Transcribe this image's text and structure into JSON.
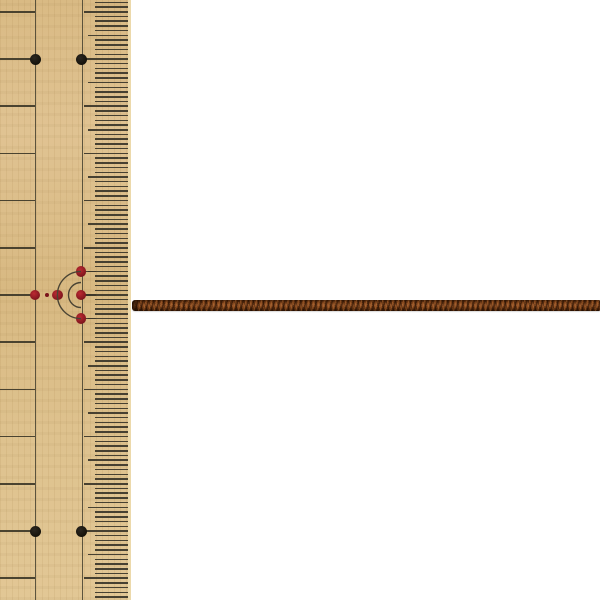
{
  "scene": {
    "width": 600,
    "height": 600,
    "background_color": "#ffffff",
    "description": "Product photo: thin brown braided cord laid horizontally across a white background, wooden ruler along the left edge for scale"
  },
  "ruler": {
    "kind": "wooden-measuring-ruler",
    "x": 0,
    "y": 0,
    "width": 131,
    "height": 600,
    "base_color": "#dcbf8c",
    "edge_strip": {
      "x": 128,
      "width": 3,
      "color": "#ecd9ab"
    },
    "line_color": "#3e3a2b",
    "tick_color": "#3a3529",
    "vertical_lines_x": [
      35,
      82
    ],
    "grid": {
      "phase_y": 11.8,
      "cm_spacing": 47.2,
      "mm_spacing": 4.72
    },
    "left_lines": {
      "x_start": 0,
      "x_end": 35,
      "thickness": 1.6
    },
    "ticks": {
      "mm_x_start": 95,
      "half_cm_x_start": 88,
      "cm_x_start": 83.5,
      "x_end": 128,
      "thickness": 1.5
    },
    "black_dots": {
      "color_outer": "#2b2720",
      "color_inner": "#141109",
      "radius": 5.5,
      "rows_y": [
        59,
        531
      ],
      "cols_x": [
        35.5,
        81
      ]
    },
    "red_mark": {
      "dot_color_outer": "#bc2a32",
      "dot_color_inner": "#7a141b",
      "dot_radius": 5.4,
      "small_dot_radius": 2.2,
      "dots": [
        {
          "x": 35,
          "y": 295
        },
        {
          "x": 57.4,
          "y": 295
        },
        {
          "x": 81,
          "y": 271.4
        },
        {
          "x": 81,
          "y": 295
        },
        {
          "x": 81,
          "y": 318.6
        }
      ],
      "small_dots": [
        {
          "x": 47,
          "y": 295
        }
      ],
      "arcs": {
        "cx": 81,
        "cy": 295,
        "radii": [
          23.6,
          12.5
        ],
        "stroke": "#4a4434",
        "stroke_width": 1.4
      },
      "connector_rows_y": [
        271.4,
        295,
        318.6
      ],
      "connector_x": {
        "start": 81,
        "end": 96
      }
    }
  },
  "cord": {
    "kind": "braided-cord",
    "x_start": 132,
    "x_end": 600,
    "y_top": 300,
    "height": 11,
    "color_base": "#7a431f",
    "color_dark": "#3a1d08",
    "color_light": "#a05c2a"
  }
}
